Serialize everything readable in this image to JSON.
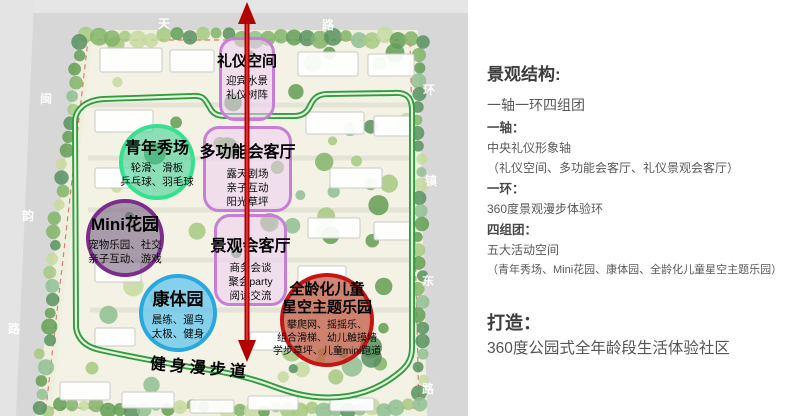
{
  "plan": {
    "road_labels": {
      "top": [
        "天",
        "路"
      ],
      "left": [
        "闽",
        "韵",
        "路"
      ],
      "right": [
        "环",
        "镇",
        "东",
        "路"
      ]
    },
    "axis_zones": [
      {
        "title": "礼仪空间",
        "items": [
          "迎宾水景",
          "礼仪树阵"
        ]
      },
      {
        "title": "多功能会客厅",
        "items": [
          "露天剧场",
          "亲子互动",
          "阳光草坪"
        ]
      },
      {
        "title": "景观会客厅",
        "items": [
          "商务会谈",
          "聚会party",
          "阅读交流"
        ]
      }
    ],
    "cluster_zones": [
      {
        "title": "青年秀场",
        "items": [
          "轮滑、滑板",
          "乒乓球、羽毛球"
        ],
        "color": "#35e08e"
      },
      {
        "title": "Mini花园",
        "items": [
          "宠物乐园、社交",
          "亲子互动、游戏"
        ],
        "color": "#7b2d8b"
      },
      {
        "title": "康体园",
        "items": [
          "晨练、遛鸟",
          "太极、健身"
        ],
        "color": "#2aa7de"
      },
      {
        "title": "全龄化儿童",
        "title2": "星空主题乐园",
        "items": [
          "攀爬网、摇摇乐、",
          "组合滑梯、幼儿触摸墙",
          "学步草坪、儿童mini跑道"
        ],
        "color": "#c51414"
      }
    ],
    "loop_label": "健身漫步道",
    "colors": {
      "axis_arrow": "#b50000",
      "loop_ring": "#2f9e3f",
      "axis_zone_border": "#c77fd6",
      "axis_zone_fill": "rgba(237,205,242,0.55)"
    }
  },
  "panel": {
    "title": "景观结构:",
    "subtitle": "一轴一环四组团",
    "sections": [
      {
        "label": "一轴：",
        "lines": [
          "中央礼仪形象轴",
          "（礼仪空间、多功能会客厅、礼仪景观会客厅）"
        ]
      },
      {
        "label": "一环：",
        "lines": [
          "360度景观漫步体验环"
        ]
      },
      {
        "label": "四组团：",
        "lines": [
          "五大活动空间",
          "（青年秀场、Mini花园、康体园、全龄化儿童星空主题乐园）"
        ]
      }
    ],
    "goal_label": "打造：",
    "goal_text": "360度公园式全年龄段生活体验社区"
  }
}
